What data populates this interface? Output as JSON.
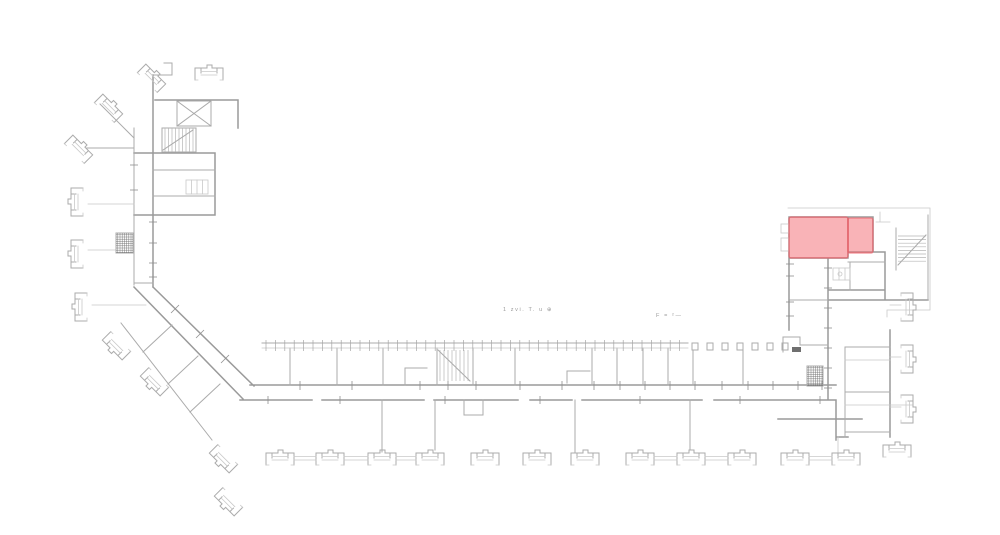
{
  "page": {
    "background": "#ffffff"
  },
  "drawing": {
    "type": "architectural-floor-plan",
    "wall_color": "#9a9a9a",
    "detail_color": "#c9c9c9",
    "highlight": {
      "fill": "rgba(243,104,112,0.5)",
      "stroke": "rgba(236,90,99,0.55)",
      "rooms": [
        {
          "x": 789,
          "y": 217,
          "w": 59,
          "h": 41
        },
        {
          "x": 848,
          "y": 218,
          "w": 25,
          "h": 35
        }
      ]
    },
    "annotations": [
      {
        "text": "1 zvi. T. u ⊕"
      },
      {
        "text": "F = ²—"
      }
    ],
    "pillars": {
      "x": 692,
      "y": 343,
      "w": 6,
      "h": 7,
      "step": 15,
      "count": 7
    },
    "window_ticks": {
      "x1": 266,
      "x2": 687,
      "step": 9.4,
      "y1": 340,
      "y2": 351
    },
    "door_ticks": {
      "y1": 381,
      "y2": 390,
      "xs": [
        300,
        352,
        420,
        448,
        476,
        520,
        562,
        594,
        620,
        645,
        670,
        695,
        722,
        748,
        773,
        798,
        822
      ]
    },
    "tick_groups": [
      {
        "axis": "h",
        "half": 4,
        "x": 153,
        "ys": [
          222,
          243,
          263,
          277
        ]
      },
      {
        "axis": "h",
        "half": 4,
        "x": 134,
        "ys": [
          165,
          190
        ]
      },
      {
        "axis": "h",
        "half": 4,
        "x": 828,
        "ys": [
          268,
          288,
          308,
          328,
          348,
          368,
          388
        ]
      },
      {
        "axis": "h",
        "half": 4,
        "x": 790,
        "ys": [
          264,
          276,
          302,
          316
        ]
      },
      {
        "axis": "v",
        "half": 4,
        "y": 400,
        "xs": [
          268,
          340,
          445,
          540,
          640,
          740,
          820
        ]
      }
    ],
    "diag_ticks": [
      [
        171,
        313,
        179,
        305
      ],
      [
        196,
        338,
        204,
        330
      ],
      [
        221,
        363,
        229,
        355
      ]
    ],
    "stairs": [
      {
        "dir": "v",
        "from": 165,
        "to": 193,
        "step": 3.5,
        "a": 128,
        "b": 152,
        "diag": [
          163,
          150,
          193,
          130
        ]
      },
      {
        "dir": "v",
        "from": 440,
        "to": 468,
        "step": 4,
        "a": 350,
        "b": 381,
        "diag": [
          438,
          350,
          470,
          381
        ]
      },
      {
        "dir": "h",
        "from": 236,
        "to": 264,
        "step": 3.6,
        "a": 898,
        "b": 926,
        "diag": [
          898,
          265,
          926,
          235
        ]
      }
    ],
    "hatches": [
      {
        "x": 116,
        "y": 233,
        "w": 17,
        "h": 20
      },
      {
        "x": 807,
        "y": 366,
        "w": 16,
        "h": 20
      }
    ],
    "dark_marks": [
      {
        "x": 792,
        "y": 347,
        "w": 9,
        "h": 5
      }
    ],
    "bays": {
      "bottom": [
        {
          "tx": 266,
          "ty": 450,
          "r": 0
        },
        {
          "tx": 316,
          "ty": 450,
          "r": 0
        },
        {
          "tx": 368,
          "ty": 450,
          "r": 0
        },
        {
          "tx": 416,
          "ty": 450,
          "r": 0
        },
        {
          "tx": 471,
          "ty": 450,
          "r": 0
        },
        {
          "tx": 523,
          "ty": 450,
          "r": 0
        },
        {
          "tx": 571,
          "ty": 450,
          "r": 0
        },
        {
          "tx": 626,
          "ty": 450,
          "r": 0
        },
        {
          "tx": 677,
          "ty": 450,
          "r": 0
        },
        {
          "tx": 728,
          "ty": 450,
          "r": 0
        },
        {
          "tx": 781,
          "ty": 450,
          "r": 0
        },
        {
          "tx": 832,
          "ty": 450,
          "r": 0
        },
        {
          "tx": 883,
          "ty": 442,
          "r": 0
        },
        {
          "tx": 195,
          "ty": 65,
          "r": 0
        }
      ],
      "rotated": [
        {
          "tx": 68,
          "ty": 216,
          "r": -90
        },
        {
          "tx": 68,
          "ty": 268,
          "r": -90
        },
        {
          "tx": 72,
          "ty": 321,
          "r": -90
        },
        {
          "tx": 916,
          "ty": 293,
          "r": 90
        },
        {
          "tx": 916,
          "ty": 345,
          "r": 90
        },
        {
          "tx": 916,
          "ty": 395,
          "r": 90
        },
        {
          "tx": 105,
          "ty": 92,
          "r": 45
        },
        {
          "tx": 75,
          "ty": 133,
          "r": 45
        },
        {
          "tx": 148,
          "ty": 62,
          "r": 45
        },
        {
          "tx": 120,
          "ty": 362,
          "r": -135
        },
        {
          "tx": 158,
          "ty": 398,
          "r": -135
        },
        {
          "tx": 227,
          "ty": 475,
          "r": -135
        },
        {
          "tx": 232,
          "ty": 518,
          "r": -135
        }
      ],
      "connectors": [
        [
          294,
          316
        ],
        [
          344,
          368
        ],
        [
          396,
          416
        ],
        [
          654,
          677
        ],
        [
          705,
          728
        ],
        [
          809,
          832
        ]
      ]
    }
  }
}
